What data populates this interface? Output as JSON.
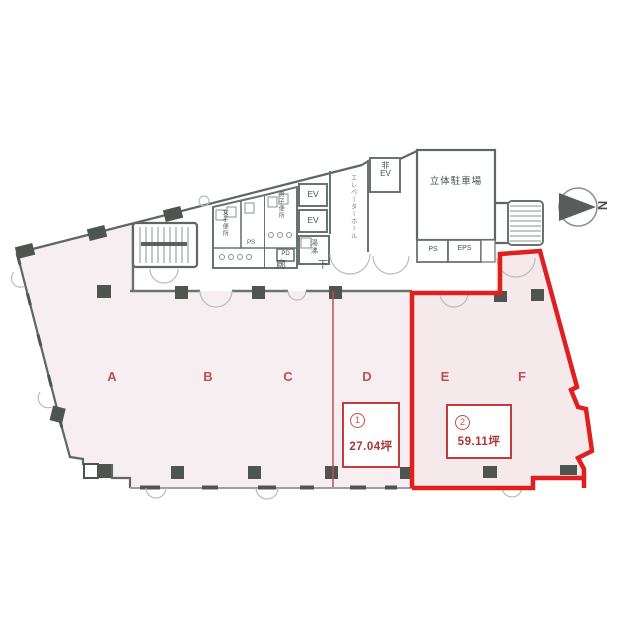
{
  "zones": [
    {
      "label": "A"
    },
    {
      "label": "B"
    },
    {
      "label": "C"
    },
    {
      "label": "D"
    },
    {
      "label": "E"
    },
    {
      "label": "F"
    }
  ],
  "units": [
    {
      "number": "1",
      "area": "27.04坪"
    },
    {
      "number": "2",
      "area": "59.11坪"
    }
  ],
  "rooms": {
    "parking": "立体駐車場",
    "elevator_hall": "エレベーターホール",
    "ev_upper": "EV",
    "ev_lower": "EV",
    "emergency_ev": "非\nEV",
    "ps_parking": "PS",
    "eps": "EPS",
    "ps_core": "PS",
    "pd": "PD",
    "kitchenette": "湯沸",
    "womens_wc": "女子便所",
    "mens_wc": "男子便所",
    "corridor": "廊下"
  },
  "compass": {
    "north": "N"
  },
  "colors": {
    "highlight_red": "#e01f1f",
    "accent_red": "#c0504d",
    "wall_gray": "#5f6663",
    "floor_pink": "#f7eef1"
  }
}
